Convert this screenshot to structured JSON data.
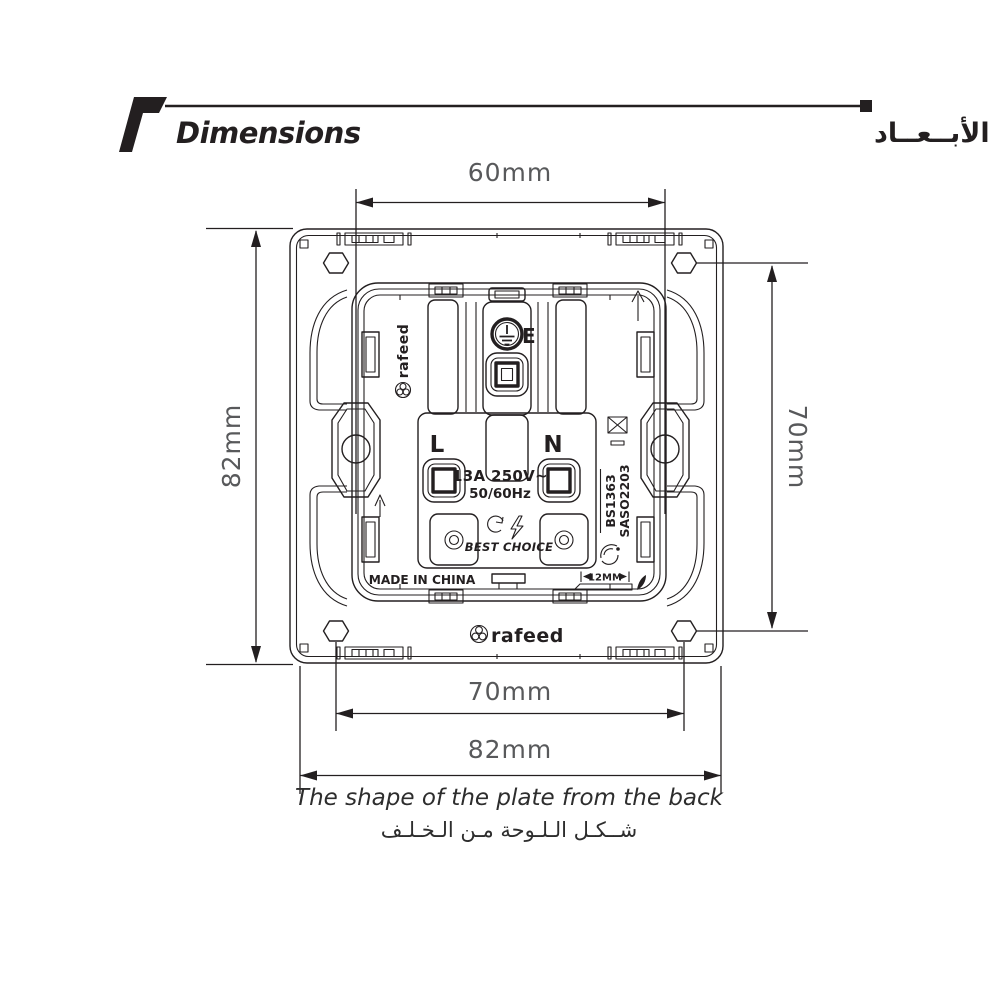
{
  "header": {
    "title_en": "Dimensions",
    "title_ar": "الأبــعــاد"
  },
  "dims": {
    "top": "60mm",
    "left": "82mm",
    "right": "70mm",
    "bottom_inner": "70mm",
    "bottom_outer": "82mm"
  },
  "caption": {
    "en": "The shape of the plate from the back",
    "ar": "شــكـل الـلـوحة مـن الـخـلـف"
  },
  "markings": {
    "brand_side": "rafeed",
    "brand_bottom": "rafeed",
    "earth": "E",
    "live": "L",
    "neutral": "N",
    "rating1": "13A 250V~",
    "rating2": "50/60Hz",
    "best_choice": "BEST CHOICE",
    "made_in": "MADE IN CHINA",
    "standard1": "BS1363",
    "standard2": "SASO2203",
    "strip_length": "12MM"
  },
  "icons": {
    "section_marker": "flag-icon",
    "earth_terminal": "earth-symbol-icon",
    "do_not_discard": "crossed-box-icon",
    "orientation": "up-arrow-icon",
    "quality_mark": "saso-quality-mark-icon",
    "best_choice_energy": "lightning-icon",
    "best_choice_cycle": "circular-arrow-icon",
    "brand_logo": "rafeed-petal-logo-icon",
    "strip_leaf": "leaf-icon"
  },
  "colors": {
    "background": "#ffffff",
    "line": "#231f20",
    "dim_text": "#58595b",
    "caption_text": "#2d2d2d",
    "header_text": "#000000"
  }
}
